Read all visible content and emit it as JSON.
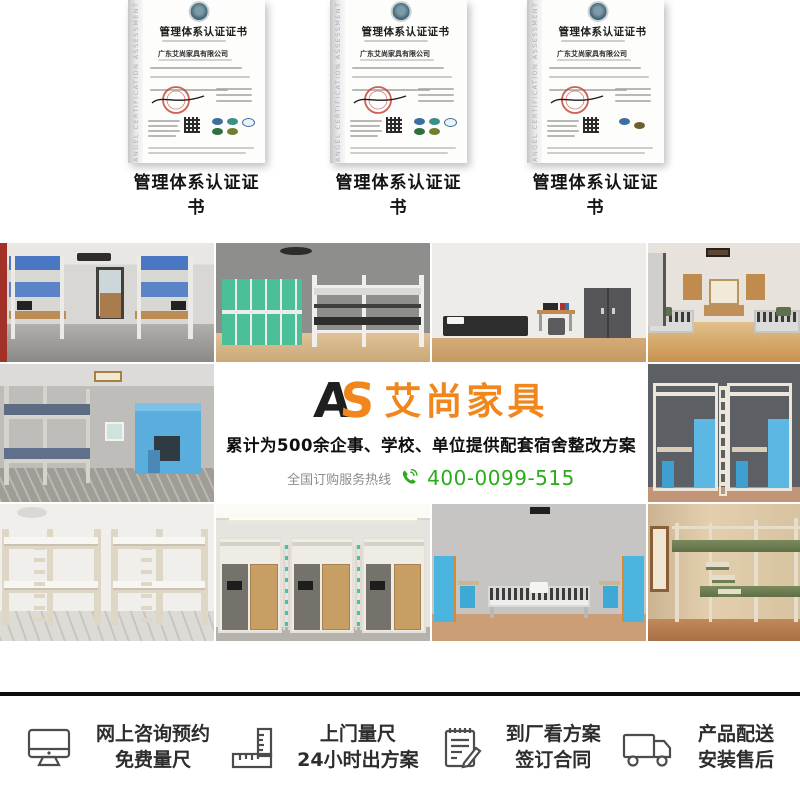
{
  "certificates_section": {
    "side_text": "ANGEL CERTIFICATION ASSESSMENT SERVICES",
    "certificates": [
      {
        "title": "管理体系认证证书",
        "company": "广东艾尚家具有限公司",
        "caption": "管理体系认证证书"
      },
      {
        "title": "管理体系认证证书",
        "company": "广东艾尚家具有限公司",
        "caption": "管理体系认证证书"
      },
      {
        "title": "管理体系认证证书",
        "company": "广东艾尚家具有限公司",
        "caption": "管理体系认证证书"
      }
    ]
  },
  "banner": {
    "logo": {
      "mark_a": "A",
      "mark_s": "S",
      "name": "艾尚家具"
    },
    "headline": "累计为500余企事、学校、单位提供配套宿舍整改方案",
    "hotline_label": "全国订购服务热线",
    "phone": "400-0099-515",
    "colors": {
      "brand_orange": "#f0861c",
      "phone_green": "#2bab1a"
    }
  },
  "gallery": {
    "photos": [
      {
        "id": "r1c1",
        "alt": "dorm room with blue bunk beds and desks"
      },
      {
        "id": "r1c2",
        "alt": "teal lockers beside white bunk beds"
      },
      {
        "id": "r1c3",
        "alt": "single bed with desk and dark cabinet"
      },
      {
        "id": "r1c4",
        "alt": "wooden cabinets and metal beds with green bedding"
      },
      {
        "id": "r2c1",
        "alt": "gray dorm with bunk beds and sky blue wardrobe desks"
      },
      {
        "id": "r2c4",
        "alt": "dark loft bed units with blue wardrobes and desks"
      },
      {
        "id": "r3c1",
        "alt": "cream bunk beds in white room"
      },
      {
        "id": "r3c2",
        "alt": "loft bed combo units with wardrobe and desk below"
      },
      {
        "id": "r3c3",
        "alt": "single beds with blue wardrobes and chairs"
      },
      {
        "id": "r3c4",
        "alt": "green metal loft bed with stairs"
      }
    ]
  },
  "services": {
    "items": [
      {
        "icon": "monitor-icon",
        "line1": "网上咨询预约",
        "line2": "免费量尺"
      },
      {
        "icon": "ruler-icon",
        "line1": "上门量尺",
        "line2": "24小时出方案"
      },
      {
        "icon": "contract-icon",
        "line1": "到厂看方案",
        "line2": "签订合同"
      },
      {
        "icon": "truck-icon",
        "line1": "产品配送",
        "line2": "安装售后"
      }
    ]
  }
}
